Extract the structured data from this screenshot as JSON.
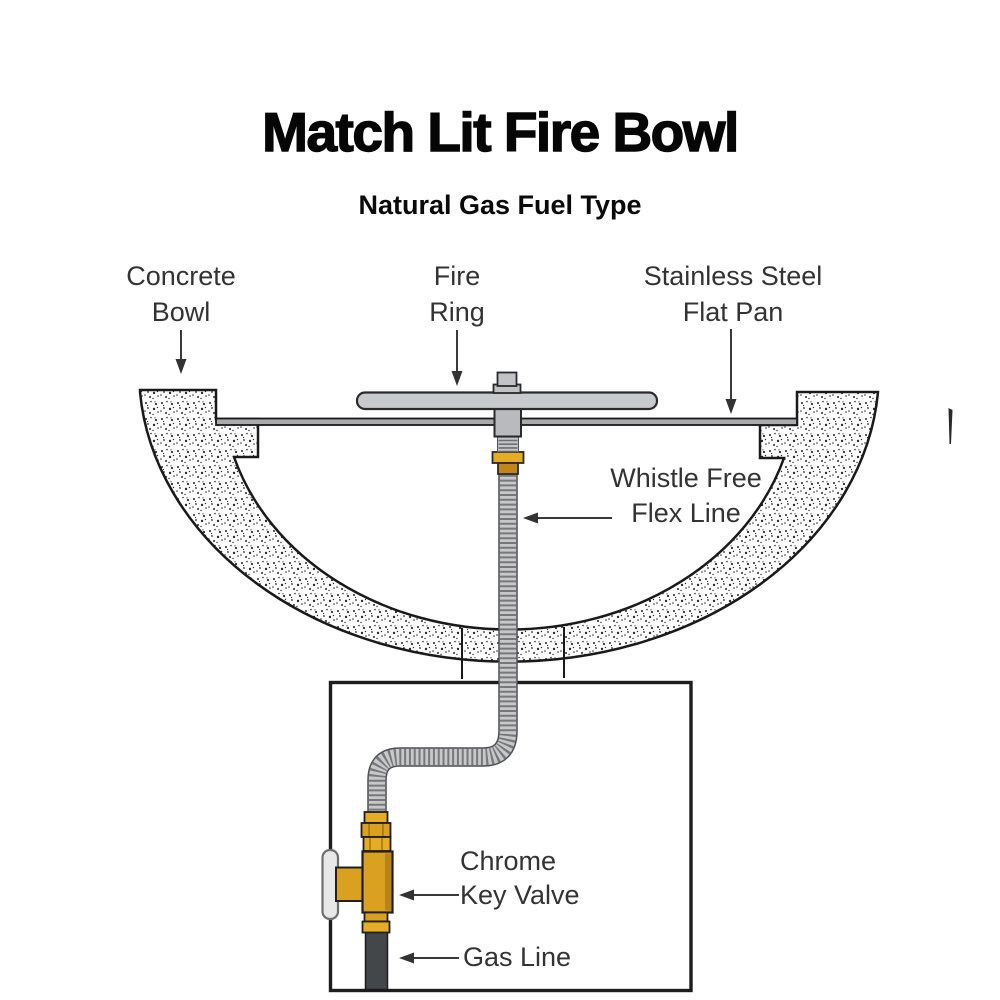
{
  "header": {
    "title": "Match Lit Fire Bowl",
    "subtitle": "Natural Gas Fuel Type"
  },
  "diagram": {
    "callouts": [
      {
        "id": "concrete-bowl",
        "line1": "Concrete",
        "line2": "Bowl"
      },
      {
        "id": "fire-ring",
        "line1": "Fire",
        "line2": "Ring"
      },
      {
        "id": "stainless-steel-flat-pan",
        "line1": "Stainless Steel",
        "line2": "Flat Pan"
      },
      {
        "id": "whistle-free-flex-line",
        "line1": "Whistle Free",
        "line2": "Flex Line"
      },
      {
        "id": "chrome-key-valve",
        "line1": "Chrome",
        "line2": "Key Valve"
      },
      {
        "id": "gas-line",
        "line1": "Gas Line",
        "line2": ""
      }
    ],
    "colors": {
      "brass": "#D9A11F",
      "brass_bright": "#E6AC24",
      "brass_dark": "#C18518",
      "fire_ring_steel": "#c9cacd",
      "pan_steel": "#a9abae",
      "hardware_gray": "#b9babd",
      "flex_body": "#c7c8ca",
      "flex_rib": "#77787c",
      "chrome": "#e8e8e8",
      "gas_line": "#44474a",
      "ink": "#333333",
      "outline": "#1a1a1a"
    }
  }
}
